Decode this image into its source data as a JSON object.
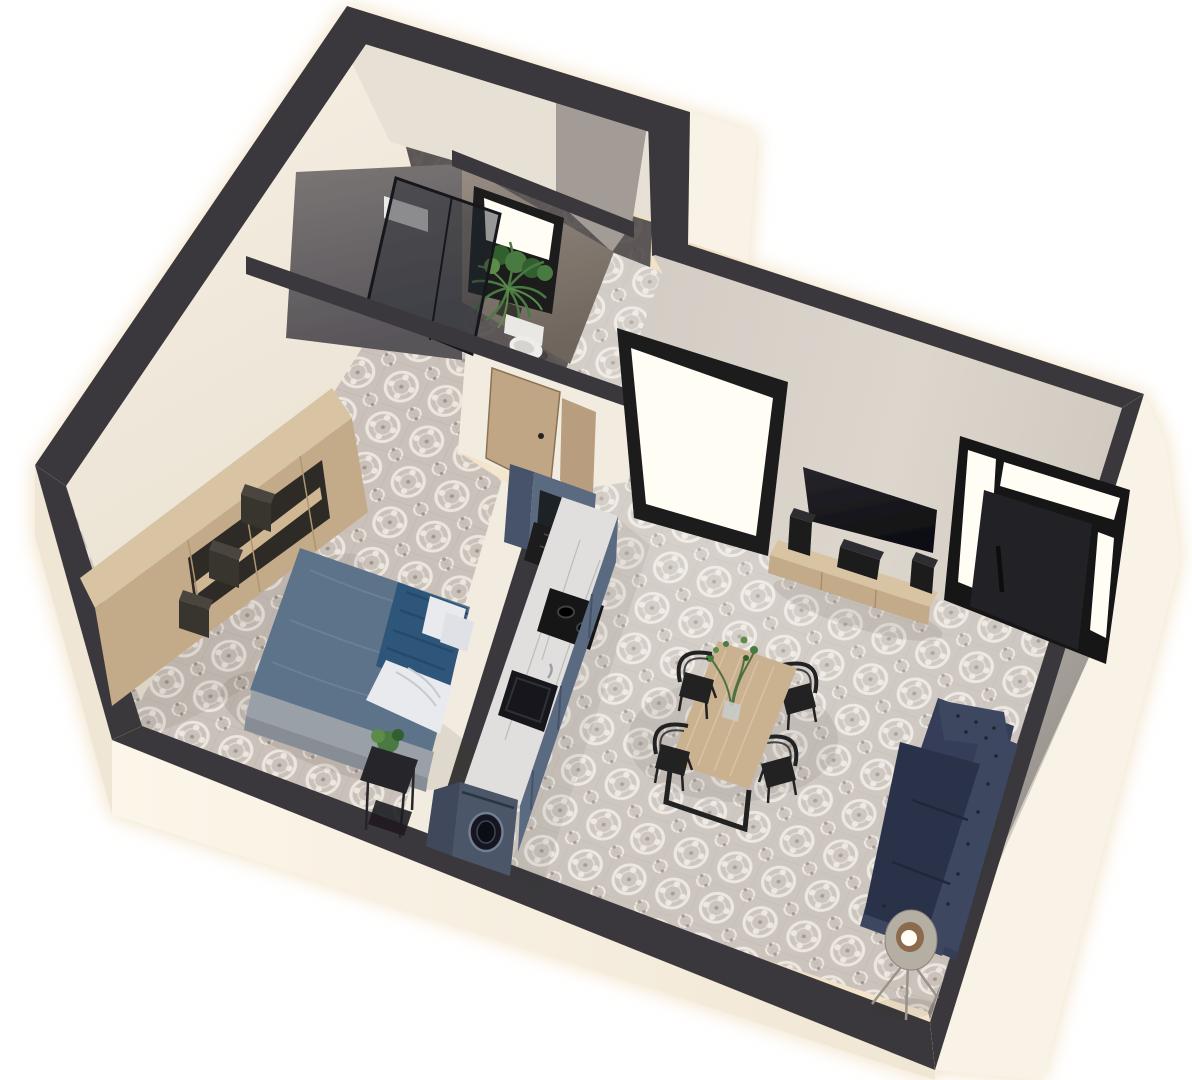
{
  "meta": {
    "view": "3D isometric cutaway floor plan render",
    "width_px": 1192,
    "height_px": 1080,
    "visible_text": ""
  },
  "palette": {
    "page_bg": "#ffffff",
    "wall_top_band": "#3a383c",
    "ext_bright": "#f9f3e7",
    "ext_shadow": "#efe6d6",
    "int_cream": "#f2ebdf",
    "int_gray": "#e7e0d4",
    "int_taupe": "#d8d2c9",
    "bath_wall_concrete": "#6e6a6c",
    "bath_wall_brown": "#847a71",
    "bath_floor": "#4e494a",
    "tile_base": "#c9c1ba",
    "tile_motif": "#ece6df",
    "tile_accent": "#a2978f",
    "wood_light": "#d8c3a2",
    "wood_mid": "#c3aa89",
    "wood_door": "#c0a685",
    "dining_wood": "#cab291",
    "cabinet_blue": "#5a6a81",
    "cabinet_blue_dark": "#47536a",
    "counter_marble": "#e0dfde",
    "appliance_black": "#1b1a1e",
    "washer_blue": "#4b5669",
    "bed_duvet": "#5d7389",
    "bed_blanket": "#2e567a",
    "bed_sheet": "#e9eaee",
    "bed_base": "#9aa0a7",
    "sofa_navy": "#363e58",
    "sofa_navy_dark": "#2b3349",
    "sofa_navy_light": "#3d4660",
    "chair_black": "#202023",
    "plant_green": "#4a7a42",
    "plant_green_dark": "#315f2e",
    "plant_green_light": "#5d8c4a",
    "lamp_shade": "#b5aea3",
    "window_glow": "#fffdf4",
    "glow_halo": "#eed9b6",
    "shadow": "#3a332c"
  },
  "scene": {
    "rooms": [
      {
        "name": "bathroom",
        "floor": "dark tile",
        "items": [
          "walk-in shower with glass enclosure",
          "white shower shelf",
          "toilet",
          "black framed window with plants",
          "concrete feature wall"
        ]
      },
      {
        "name": "bedroom",
        "floor": "patterned tile",
        "items": [
          "wooden wardrobe shelving",
          "3 dark storage boxes",
          "double bed with blue duvet and striped blanket",
          "white pillows",
          "gray upholstered bed base",
          "black side table with plant",
          "wooden interior door"
        ]
      },
      {
        "name": "kitchen",
        "floor": "patterned tile",
        "items": [
          "tall fridge column",
          "black oven unit",
          "marble countertop",
          "2-burner cooktop",
          "black sink",
          "blue base cabinets",
          "washing machine with round door"
        ]
      },
      {
        "name": "living-dining",
        "floor": "patterned tile",
        "items": [
          "floor-to-ceiling window",
          "wall mounted TV",
          "wooden media console",
          "3 speakers",
          "black entrance door with glass sidelights and transom",
          "wooden dining table",
          "4 black wire chairs",
          "vase with green branches",
          "navy tufted 3-seat sofa",
          "tripod floor lamp"
        ]
      }
    ],
    "counts": {
      "dining_chairs": 4,
      "cooktop_burners": 2,
      "speakers": 3,
      "storage_boxes": 3,
      "sofa_seats": 3
    }
  }
}
